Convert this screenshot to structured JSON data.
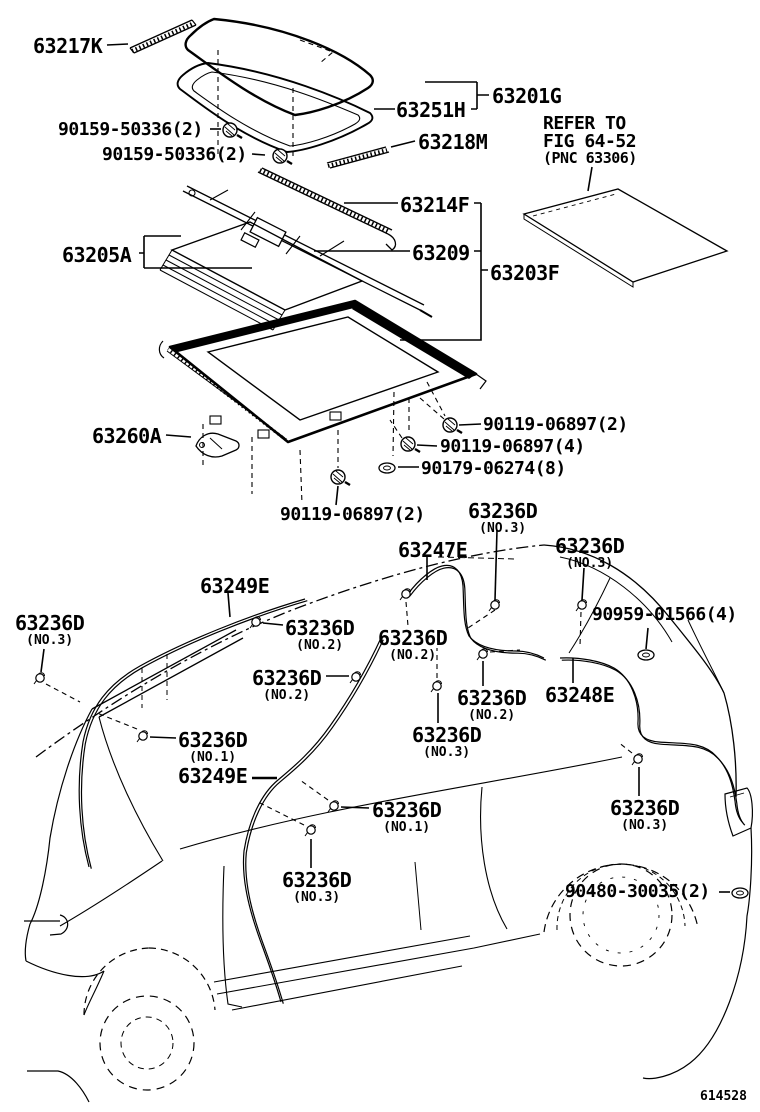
{
  "figure_code": "614528",
  "colors": {
    "ink": "#000000",
    "background": "#ffffff"
  },
  "note": {
    "line1": "REFER TO",
    "line2": "FIG 64-52",
    "line3": "(PNC 63306)"
  },
  "labels": [
    {
      "text": "63217K"
    },
    {
      "text": "90159-50336(2)"
    },
    {
      "text": "90159-50336(2)"
    },
    {
      "text": "63251H"
    },
    {
      "text": "63201G"
    },
    {
      "text": "63218M"
    },
    {
      "text": "63214F"
    },
    {
      "text": "63209"
    },
    {
      "text": "63203F"
    },
    {
      "text": "63205A"
    },
    {
      "text": "63260A"
    },
    {
      "text": "90119-06897(2)"
    },
    {
      "text": "90119-06897(4)"
    },
    {
      "text": "90179-06274(8)"
    },
    {
      "text": "90119-06897(2)"
    },
    {
      "text": "63236D",
      "sub": "(NO.3)"
    },
    {
      "text": "63247E"
    },
    {
      "text": "63236D",
      "sub": "(NO.3)"
    },
    {
      "text": "63249E"
    },
    {
      "text": "63236D",
      "sub": "(NO.3)"
    },
    {
      "text": "63236D",
      "sub": "(NO.2)"
    },
    {
      "text": "63236D",
      "sub": "(NO.2)"
    },
    {
      "text": "90959-01566(4)"
    },
    {
      "text": "63236D",
      "sub": "(NO.2)"
    },
    {
      "text": "63236D",
      "sub": "(NO.2)"
    },
    {
      "text": "63248E"
    },
    {
      "text": "63236D",
      "sub": "(NO.3)"
    },
    {
      "text": "63236D",
      "sub": "(NO.1)"
    },
    {
      "text": "63249E"
    },
    {
      "text": "63236D",
      "sub": "(NO.1)"
    },
    {
      "text": "63236D",
      "sub": "(NO.3)"
    },
    {
      "text": "63236D",
      "sub": "(NO.3)"
    },
    {
      "text": "90480-30035(2)"
    }
  ]
}
